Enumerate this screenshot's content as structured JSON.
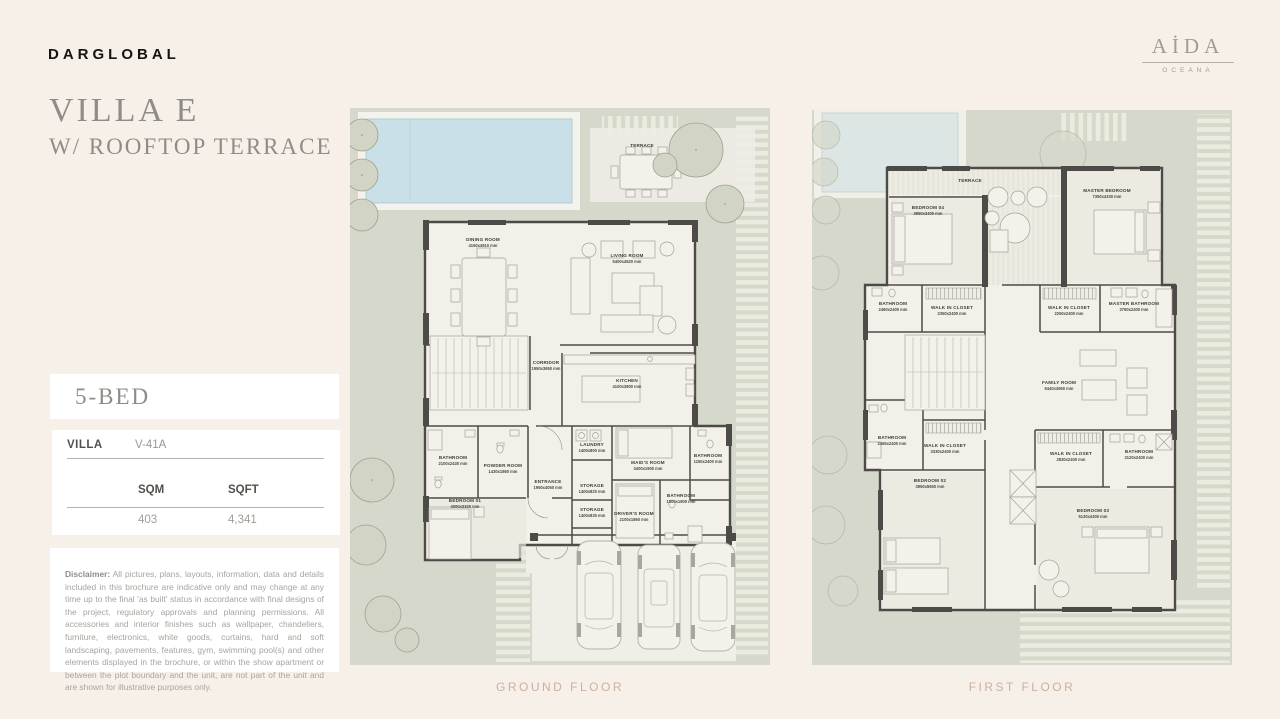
{
  "brand": {
    "name": "DARGLOBAL"
  },
  "project": {
    "name": "AİDA",
    "sub": "OCEANA"
  },
  "title": {
    "line1": "VILLA E",
    "line2": "W/ ROOFTOP TERRACE"
  },
  "unit": {
    "type": "5-BED",
    "villa_label": "VILLA",
    "villa_value": "V-41A",
    "sqm_label": "SQM",
    "sqft_label": "SQFT",
    "sqm_value": "403",
    "sqft_value": "4,341"
  },
  "disclaimer": {
    "label": "Disclaimer:",
    "text": " All pictures, plans, layouts, information, data and details included in this brochure are indicative only and may change at any time up to the final 'as built' status in accordance with final designs of the project, regulatory approvals and planning permissions. All accessories and interior finishes such as wallpaper, chandeliers, furniture, electronics, white goods, curtains, hard and soft landscaping, pavements, features, gym, swimming pool(s) and other elements displayed in the brochure, or within the show apartment or between the plot boundary and the unit, are not part of the unit and are shown for illustrative purposes only."
  },
  "colors": {
    "background": "#f6f0e9",
    "plan_background": "#d5d8ca",
    "pool": "#c9e0e8",
    "wall": "#4c4b47",
    "caption": "#ccb19c"
  },
  "floors": {
    "ground": {
      "caption": "GROUND FLOOR",
      "rooms": [
        {
          "name": "TERRACE",
          "dims": ""
        },
        {
          "name": "DINING ROOM",
          "dims": "4150x4910 mm"
        },
        {
          "name": "LIVING ROOM",
          "dims": "5400x4520 mm"
        },
        {
          "name": "CORRIDOR",
          "dims": "1950x3650 mm"
        },
        {
          "name": "KITCHEN",
          "dims": "4100x3800 mm"
        },
        {
          "name": "LAUNDRY",
          "dims": "1400x800 mm"
        },
        {
          "name": "MAID'S ROOM",
          "dims": "3400x1900 mm"
        },
        {
          "name": "BATHROOM",
          "dims": "1150x2400 mm"
        },
        {
          "name": "BATHROOM",
          "dims": "2100x2430 mm"
        },
        {
          "name": "POWDER ROOM",
          "dims": "1430x1860 mm"
        },
        {
          "name": "ENTRANCE",
          "dims": "1950x4050 mm"
        },
        {
          "name": "STORAGE",
          "dims": "1400x820 mm"
        },
        {
          "name": "STORAGE",
          "dims": "1400x830 mm"
        },
        {
          "name": "DRIVER'S ROOM",
          "dims": "2100x1860 mm"
        },
        {
          "name": "BATHROOM",
          "dims": "1500x1800 mm"
        },
        {
          "name": "BEDROOM 01",
          "dims": "4000x3320 mm"
        }
      ]
    },
    "first": {
      "caption": "FIRST FLOOR",
      "rooms": [
        {
          "name": "TERRACE",
          "dims": ""
        },
        {
          "name": "BEDROOM 04",
          "dims": "3950x3400 mm"
        },
        {
          "name": "MASTER BEDROOM",
          "dims": "7350x4330 mm"
        },
        {
          "name": "BATHROOM",
          "dims": "2460x2400 mm"
        },
        {
          "name": "WALK IN CLOSET",
          "dims": "2350x2400 mm"
        },
        {
          "name": "WALK IN CLOSET",
          "dims": "2250x2400 mm"
        },
        {
          "name": "MASTER BATHROOM",
          "dims": "3760x2400 mm"
        },
        {
          "name": "FAMILY ROOM",
          "dims": "5440x3650 mm"
        },
        {
          "name": "BATHROOM",
          "dims": "2465x2400 mm"
        },
        {
          "name": "WALK IN CLOSET",
          "dims": "3330x2400 mm"
        },
        {
          "name": "BEDROOM 02",
          "dims": "3950x5650 mm"
        },
        {
          "name": "WALK IN CLOSET",
          "dims": "2830x2400 mm"
        },
        {
          "name": "BATHROOM",
          "dims": "3120x2400 mm"
        },
        {
          "name": "BEDROOM 03",
          "dims": "5130x4300 mm"
        }
      ]
    }
  }
}
